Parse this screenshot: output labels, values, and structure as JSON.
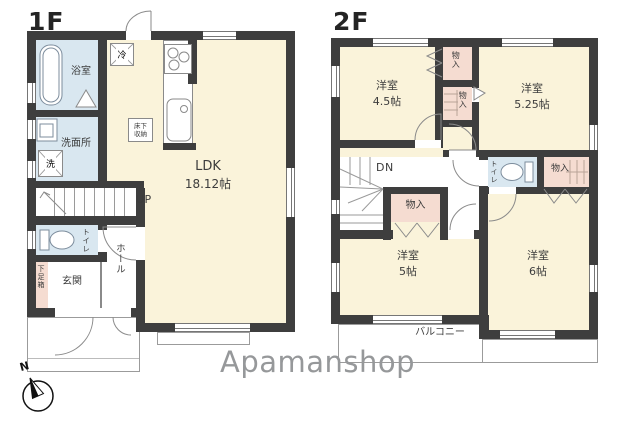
{
  "meta": {
    "type": "real-estate-floor-plan"
  },
  "colors": {
    "room_cream": "#faf3da",
    "wet_area_blue": "#d9e7f0",
    "closet_pink": "#f5dcd1",
    "wall_dark": "#3e3e3e",
    "outline_gray": "#9b9b9b",
    "logo_gray": "#96989a"
  },
  "floor1": {
    "label": "1F",
    "ldk": {
      "name": "LDK",
      "size": "18.12帖"
    },
    "bath": "浴室",
    "washroom": "洗面所",
    "washer": "洗",
    "fridge": "冷",
    "floor_storage_line1": "床下",
    "floor_storage_line2": "収納",
    "stairs_up": "UP",
    "toilet": "トイレ",
    "shoe_box": "下足箱",
    "entrance": "玄関",
    "hall": "ホール"
  },
  "floor2": {
    "label": "2F",
    "room_a": {
      "name": "洋室",
      "size": "4.5帖"
    },
    "room_b": {
      "name": "洋室",
      "size": "5.25帖"
    },
    "room_c": {
      "name": "洋室",
      "size": "5帖"
    },
    "room_d": {
      "name": "洋室",
      "size": "6帖"
    },
    "closet_top1": "物入",
    "closet_top2": "物入",
    "closet_mid": "物入",
    "closet_right": "物入",
    "stairs_down": "DN",
    "toilet": "トイレ",
    "balcony": "バルコニー"
  },
  "branding": {
    "logo_text": "Apamanshop"
  },
  "compass": {
    "north_label": "N"
  }
}
